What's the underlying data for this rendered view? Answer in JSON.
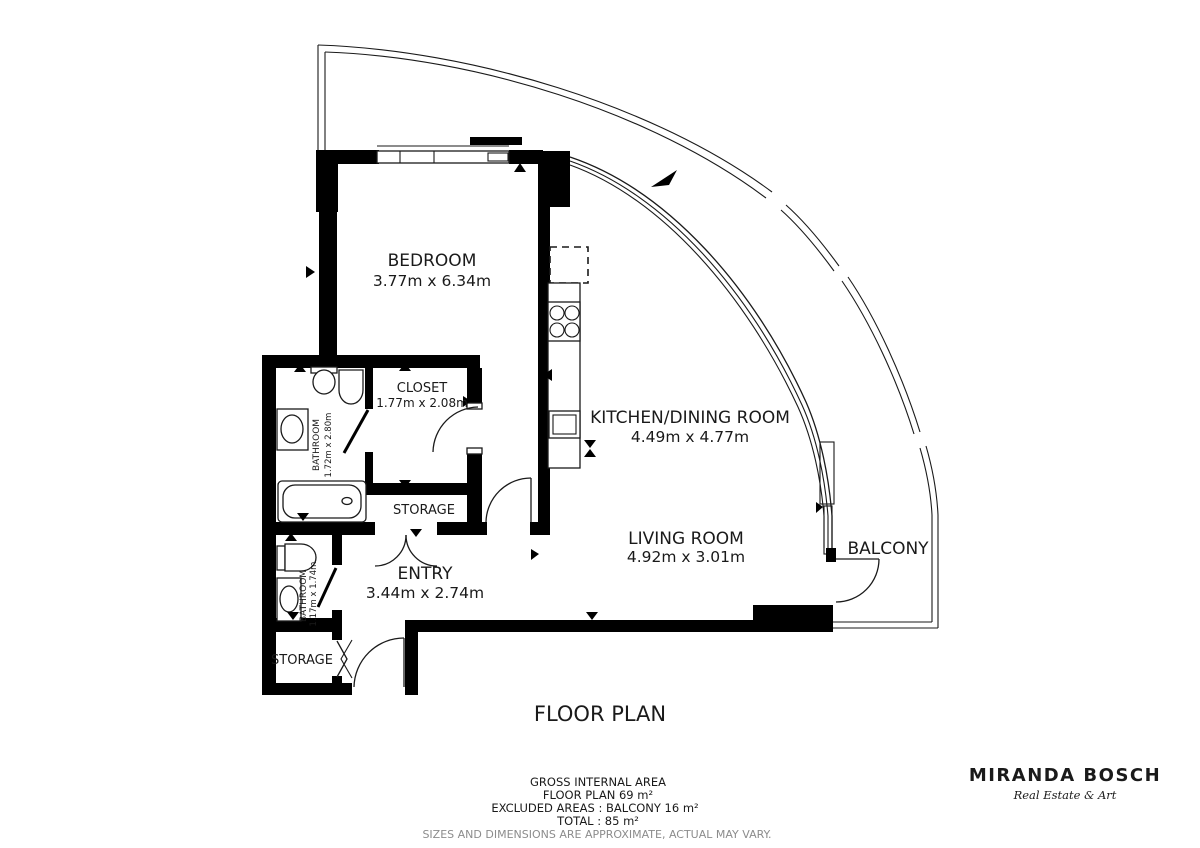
{
  "title": "FLOOR PLAN",
  "rooms": {
    "bedroom": {
      "name": "BEDROOM",
      "dims": "3.77m x 6.34m"
    },
    "closet": {
      "name": "CLOSET",
      "dims": "1.77m x 2.08m"
    },
    "bathroom1": {
      "name": "BATHROOM",
      "dims": "1.72m x 2.80m"
    },
    "storage1": {
      "name": "STORAGE"
    },
    "entry": {
      "name": "ENTRY",
      "dims": "3.44m x 2.74m"
    },
    "bathroom2": {
      "name": "BATHROOM",
      "dims": "1.17m x 1.74m"
    },
    "storage2": {
      "name": "STORAGE"
    },
    "kitchen": {
      "name": "KITCHEN/DINING ROOM",
      "dims": "4.49m x 4.77m"
    },
    "living": {
      "name": "LIVING ROOM",
      "dims": "4.92m x 3.01m"
    },
    "balcony": {
      "name": "BALCONY"
    }
  },
  "summary": {
    "heading": "GROSS INTERNAL AREA",
    "floor_plan": "FLOOR PLAN 69 m²",
    "excluded": "EXCLUDED AREAS :  BALCONY 16 m²",
    "total": "TOTAL :  85 m²",
    "disclaimer": "SIZES AND DIMENSIONS ARE APPROXIMATE, ACTUAL MAY VARY."
  },
  "branding": {
    "company": "MIRANDA BOSCH",
    "tagline": "Real Estate & Art"
  },
  "colors": {
    "wall": "#000000",
    "ink": "#1a1a1a",
    "muted": "#8c8c8c",
    "background": "#ffffff"
  }
}
